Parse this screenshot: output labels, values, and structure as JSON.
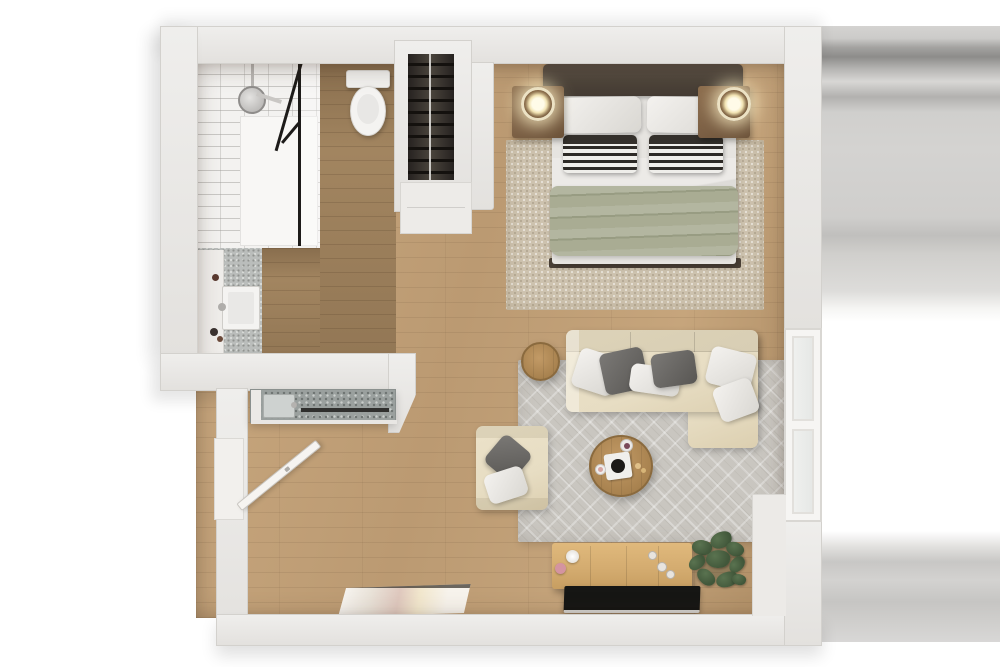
{
  "scene": {
    "title": "studio-apartment-3d-floor-plan-top-view",
    "rooms": [
      {
        "name": "bathroom",
        "features": [
          "walk-in-shower",
          "rain-shower-head",
          "black-framed-glass",
          "toilet",
          "vanity-with-sink",
          "mosaic-tile-floor"
        ]
      },
      {
        "name": "closet",
        "features": [
          "open-wardrobe",
          "hanging-rail",
          "dark-clothes-on-hangers",
          "lower-shelf"
        ]
      },
      {
        "name": "kitchenette",
        "features": [
          "terrazzo-counter",
          "inset-sink",
          "dark-appliance-slot"
        ]
      },
      {
        "name": "bedroom-area",
        "features": [
          "double-bed",
          "dark-headboard",
          "white-pillows",
          "striped-accent-pillows",
          "sage-green-duvet",
          "two-wood-nightstands",
          "two-glowing-round-lamps",
          "beige-knit-rug"
        ]
      },
      {
        "name": "living-area",
        "features": [
          "cream-l-shaped-sectional-sofa",
          "gray-and-white-throw-pillows",
          "cream-armchair",
          "round-wood-coffee-table",
          "record-player",
          "round-wood-side-table",
          "gray-chevron-rug"
        ]
      },
      {
        "name": "entry",
        "features": [
          "open-white-door",
          "leaning-framed-artwork"
        ]
      },
      {
        "name": "media-wall",
        "features": [
          "light-oak-sideboard",
          "decor-vases",
          "flat-black-tv",
          "potted-green-plant"
        ]
      }
    ],
    "window_count": 1,
    "door_count": 1,
    "view": "top-down-render-no-text"
  },
  "colors": {
    "bg": "#ffffff",
    "wall": "#e9e7e4",
    "wall_edge": "#d3d1cd",
    "wood": "#c1a078",
    "bath_wood": "#a28560",
    "tile": "#f3f2f0",
    "mosaic": "#babdbb",
    "terrazzo": "#9aa09e",
    "rug_bed": "#cdc2ae",
    "rug_living": "#c9c6c0",
    "headboard": "#4d443a",
    "mattress": "#e6e4e0",
    "duvet": "#a9ac93",
    "nightstand": "#7c6045",
    "lamp": "#f6ecc9",
    "sofa": "#e7ddc3",
    "pillow_gray": "#6f6d6a",
    "pillow_white": "#eeece8",
    "table_wood": "#b08c58",
    "sideboard": "#d4ac70",
    "tv": "#161614",
    "plant": "#41573a",
    "door": "#f6f4f1",
    "frame_black": "#1d1b19",
    "band_gray": "#8d8c8a"
  }
}
